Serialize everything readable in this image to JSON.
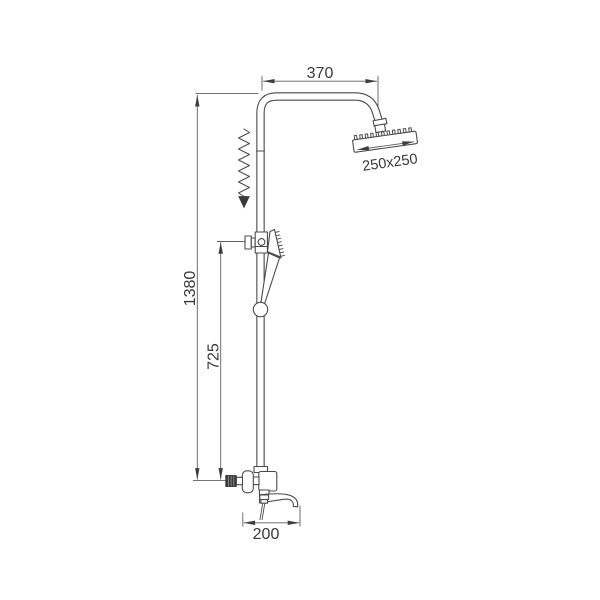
{
  "diagram": {
    "background_color": "#ffffff",
    "line_color": "#4a4a4a",
    "dimensions": {
      "arm_width": "370",
      "head_size": "250x250",
      "total_height": "1380",
      "handshower_height": "725",
      "spout_length": "200"
    }
  }
}
